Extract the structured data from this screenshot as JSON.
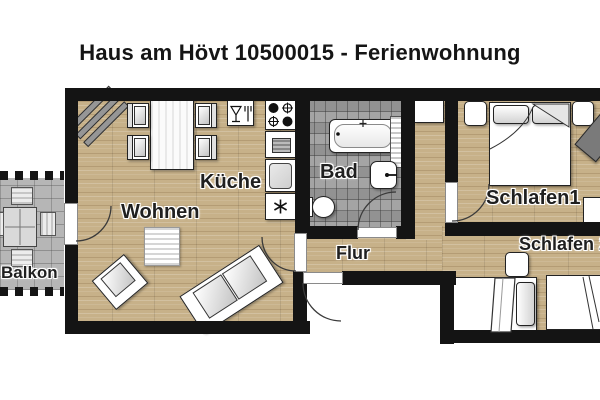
{
  "title": "Haus am Hövt 10500015 - Ferienwohnung",
  "rooms": {
    "balkon": {
      "label": "Balkon"
    },
    "wohnen": {
      "label": "Wohnen"
    },
    "kueche": {
      "label": "Küche"
    },
    "bad": {
      "label": "Bad"
    },
    "flur": {
      "label": "Flur"
    },
    "schlafen1": {
      "label": "Schlafen1"
    },
    "schlafen2": {
      "label": "Schlafen 2"
    }
  },
  "icons": {
    "dining": "wine-glass-and-fork-icon",
    "stove": "four-burner-stove-icon",
    "oven": "oven-icon",
    "sink": "kitchen-sink-icon",
    "freezer": "snowflake-asterisk-icon"
  },
  "colors": {
    "wall": "#141414",
    "wood_floor": "#c7b189",
    "tile_floor": "#9d9d9d",
    "stone_floor": "#b6b6b6",
    "furniture_outline": "#222222",
    "background": "#ffffff"
  }
}
